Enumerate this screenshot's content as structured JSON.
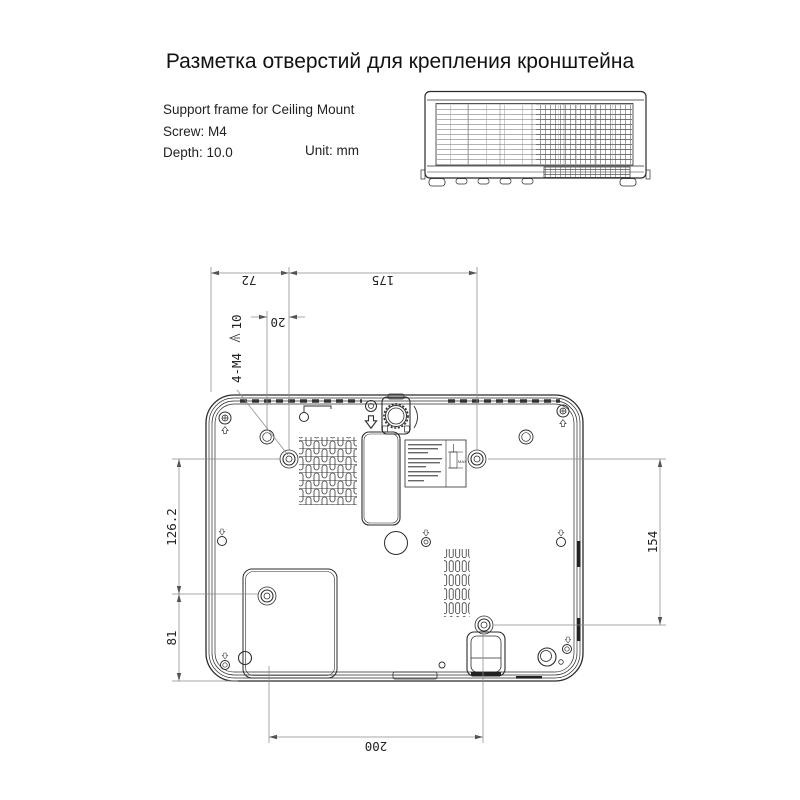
{
  "title": "Разметка отверстий для крепления кронштейна",
  "info": {
    "line1": "Support frame for Ceiling Mount",
    "line2": "Screw: M4",
    "line3": "Depth: 10.0",
    "unit": "Unit: mm"
  },
  "dimensions": {
    "top_left": "72",
    "top_right": "175",
    "hole_offset": "20",
    "callout_holes": "4-M4",
    "callout_depth": "10",
    "left_upper": "126.2",
    "left_lower": "81",
    "right_side": "154",
    "bottom": "200"
  },
  "sticker": {
    "max": "MAX"
  }
}
